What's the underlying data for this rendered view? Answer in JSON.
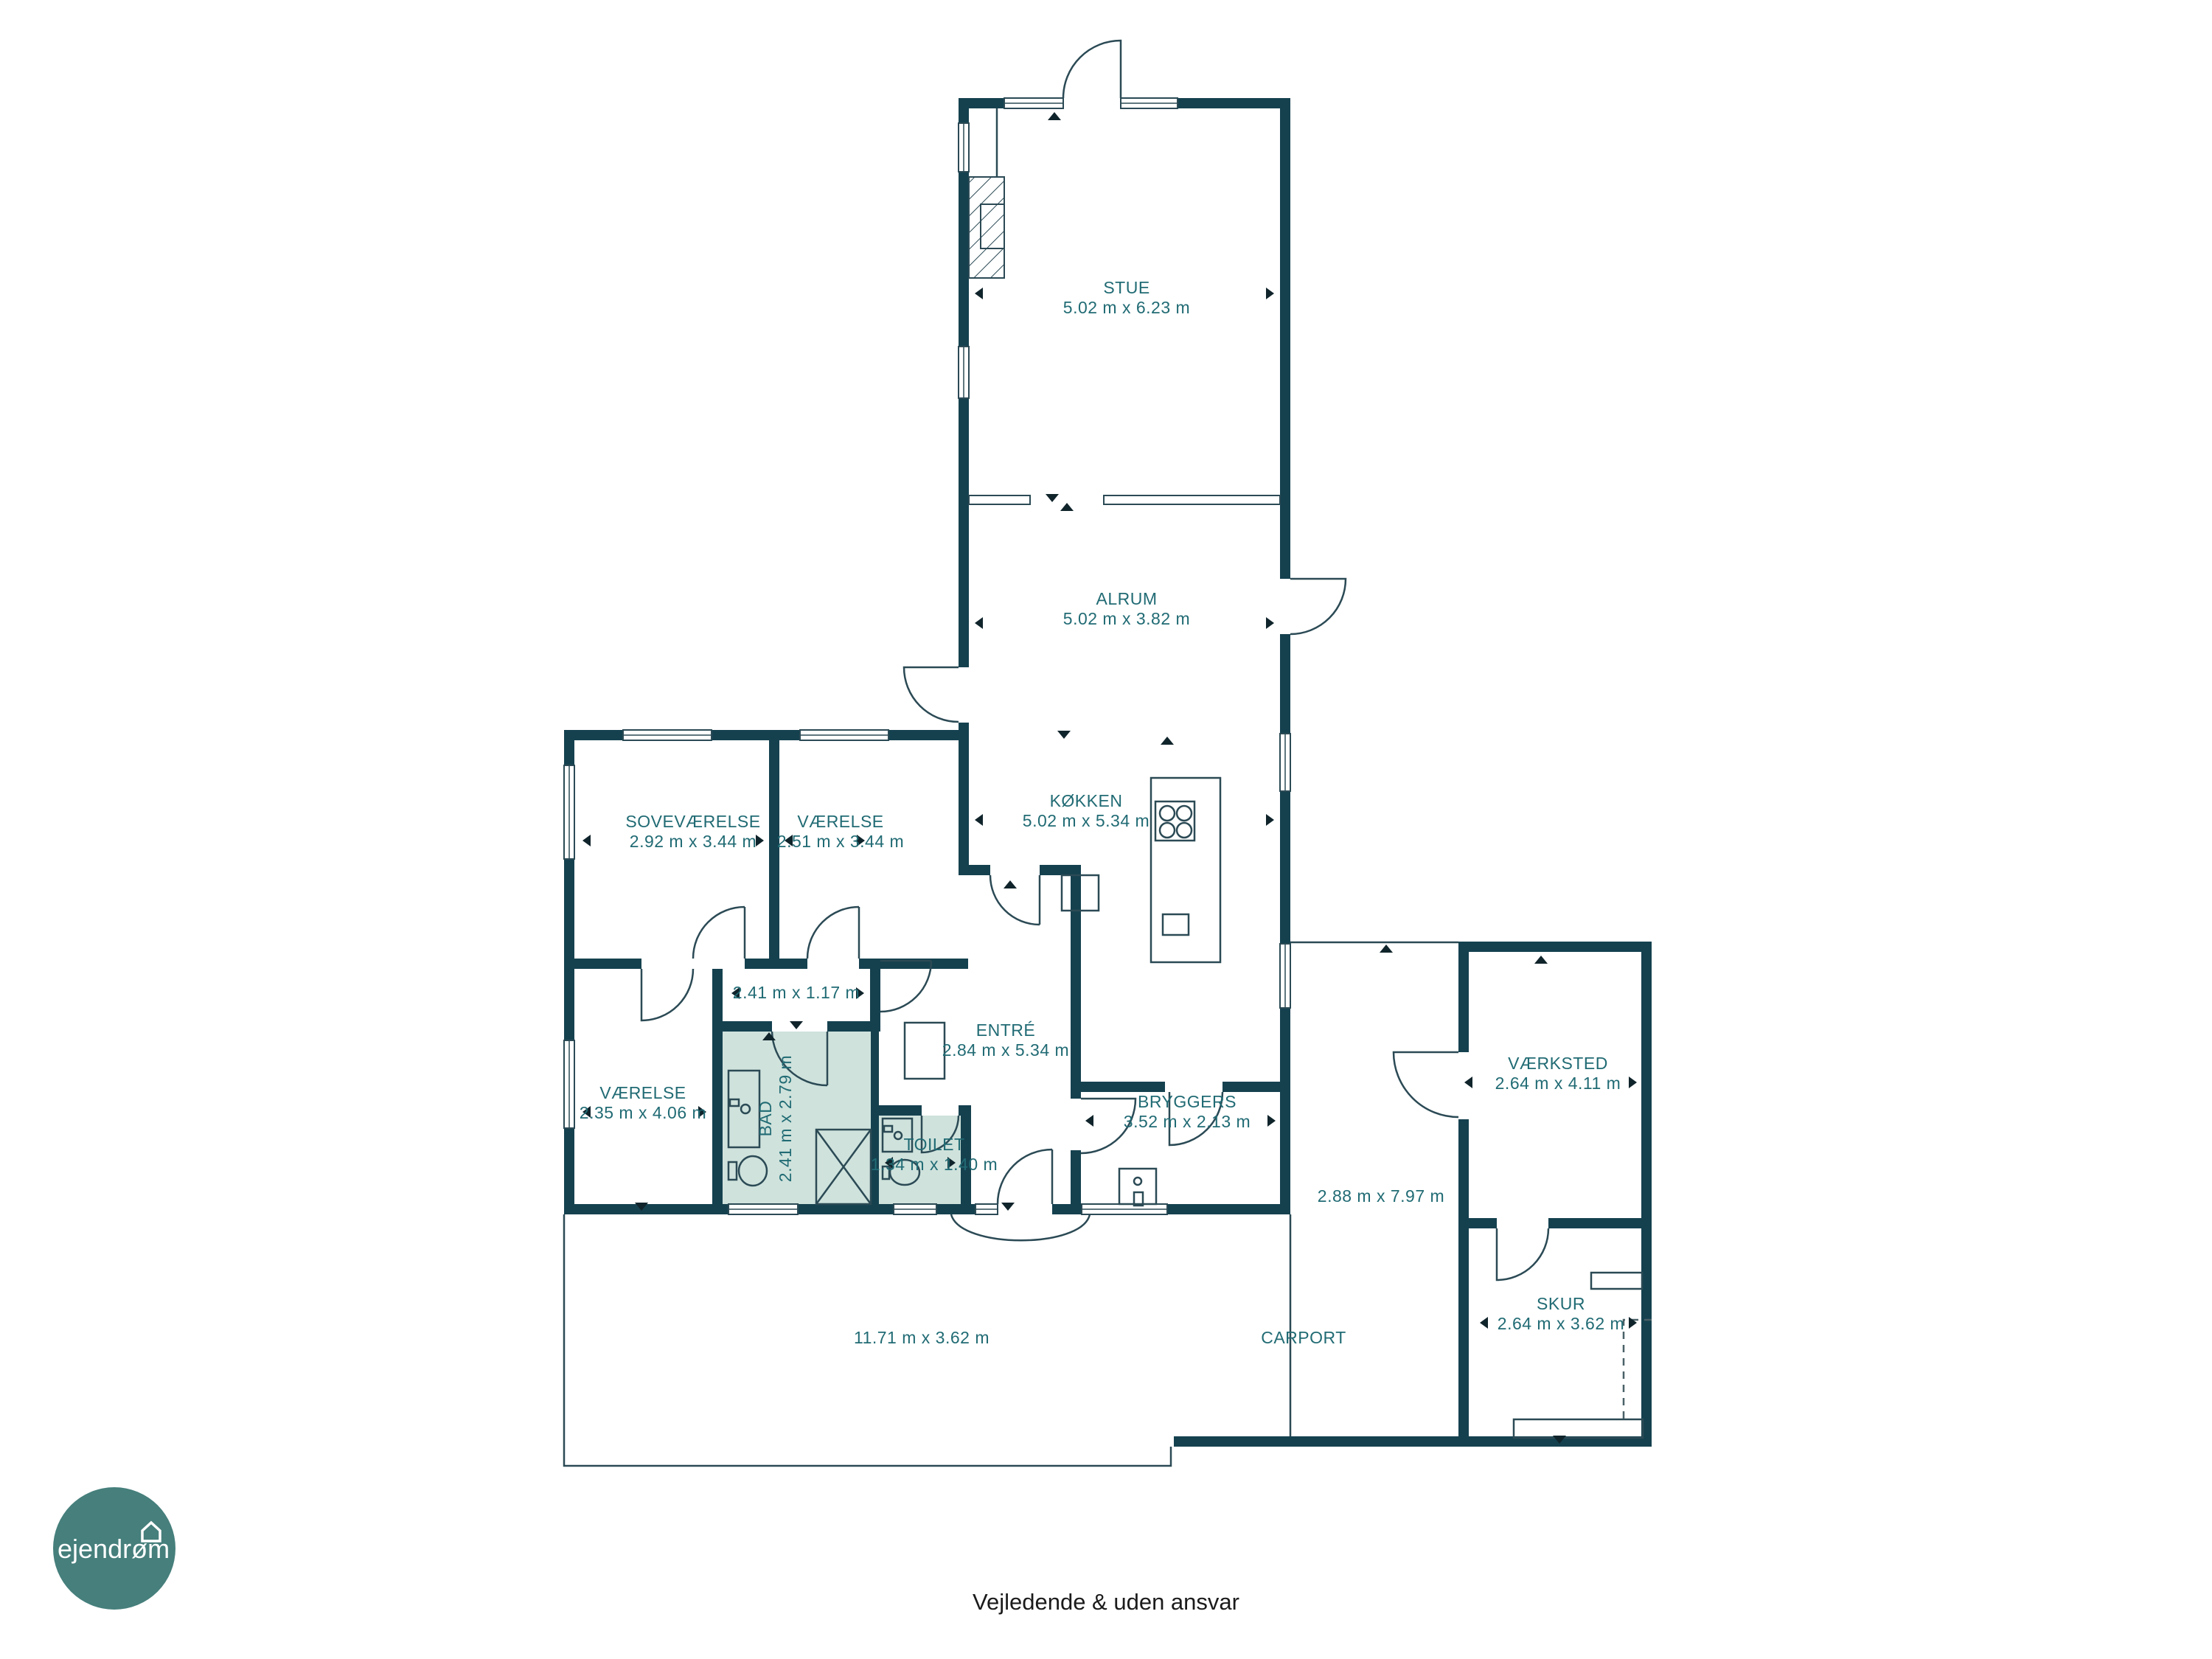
{
  "rooms": {
    "stue": {
      "name": "STUE",
      "dims": "5.02 m x 6.23 m"
    },
    "alrum": {
      "name": "ALRUM",
      "dims": "5.02 m x 3.82 m"
    },
    "kokken": {
      "name": "KØKKEN",
      "dims": "5.02 m x 5.34 m"
    },
    "sovevaerelse": {
      "name": "SOVEVÆRELSE",
      "dims": "2.92 m x 3.44 m"
    },
    "vaerelse1": {
      "name": "VÆRELSE",
      "dims": "2.51 m x 3.44 m"
    },
    "gang": {
      "dims": "2.41 m x 1.17 m"
    },
    "vaerelse2": {
      "name": "VÆRELSE",
      "dims": "2.35 m x 4.06 m"
    },
    "bad": {
      "name": "BAD",
      "dims": "2.41 m x 2.79 m"
    },
    "toilet": {
      "name": "TOILET",
      "dims": "1.34 m x 1.40 m"
    },
    "entre": {
      "name": "ENTRÉ",
      "dims": "2.84 m x 5.34 m"
    },
    "bryggers": {
      "name": "BRYGGERS",
      "dims": "3.52 m x 2.13 m"
    },
    "vaerksted": {
      "name": "VÆRKSTED",
      "dims": "2.64 m x 4.11 m"
    },
    "skur": {
      "name": "SKUR",
      "dims": "2.64 m x 3.62 m"
    },
    "carport": {
      "name": "CARPORT"
    },
    "terrasse_syd": {
      "dims": "11.71 m x 3.62 m"
    },
    "terrasse_ost": {
      "dims": "2.88 m x 7.97 m"
    }
  },
  "branding": {
    "logo_text": "ejendrøm"
  },
  "footer": {
    "disclaimer": "Vejledende & uden ansvar"
  },
  "colors": {
    "wall": "#15414f",
    "room_label": "#216b74",
    "bath_fill": "#cfe2dc",
    "logo_bg": "#467f7c",
    "thin_line": "#2b4a55",
    "footer_text": "#1b1b1b"
  }
}
